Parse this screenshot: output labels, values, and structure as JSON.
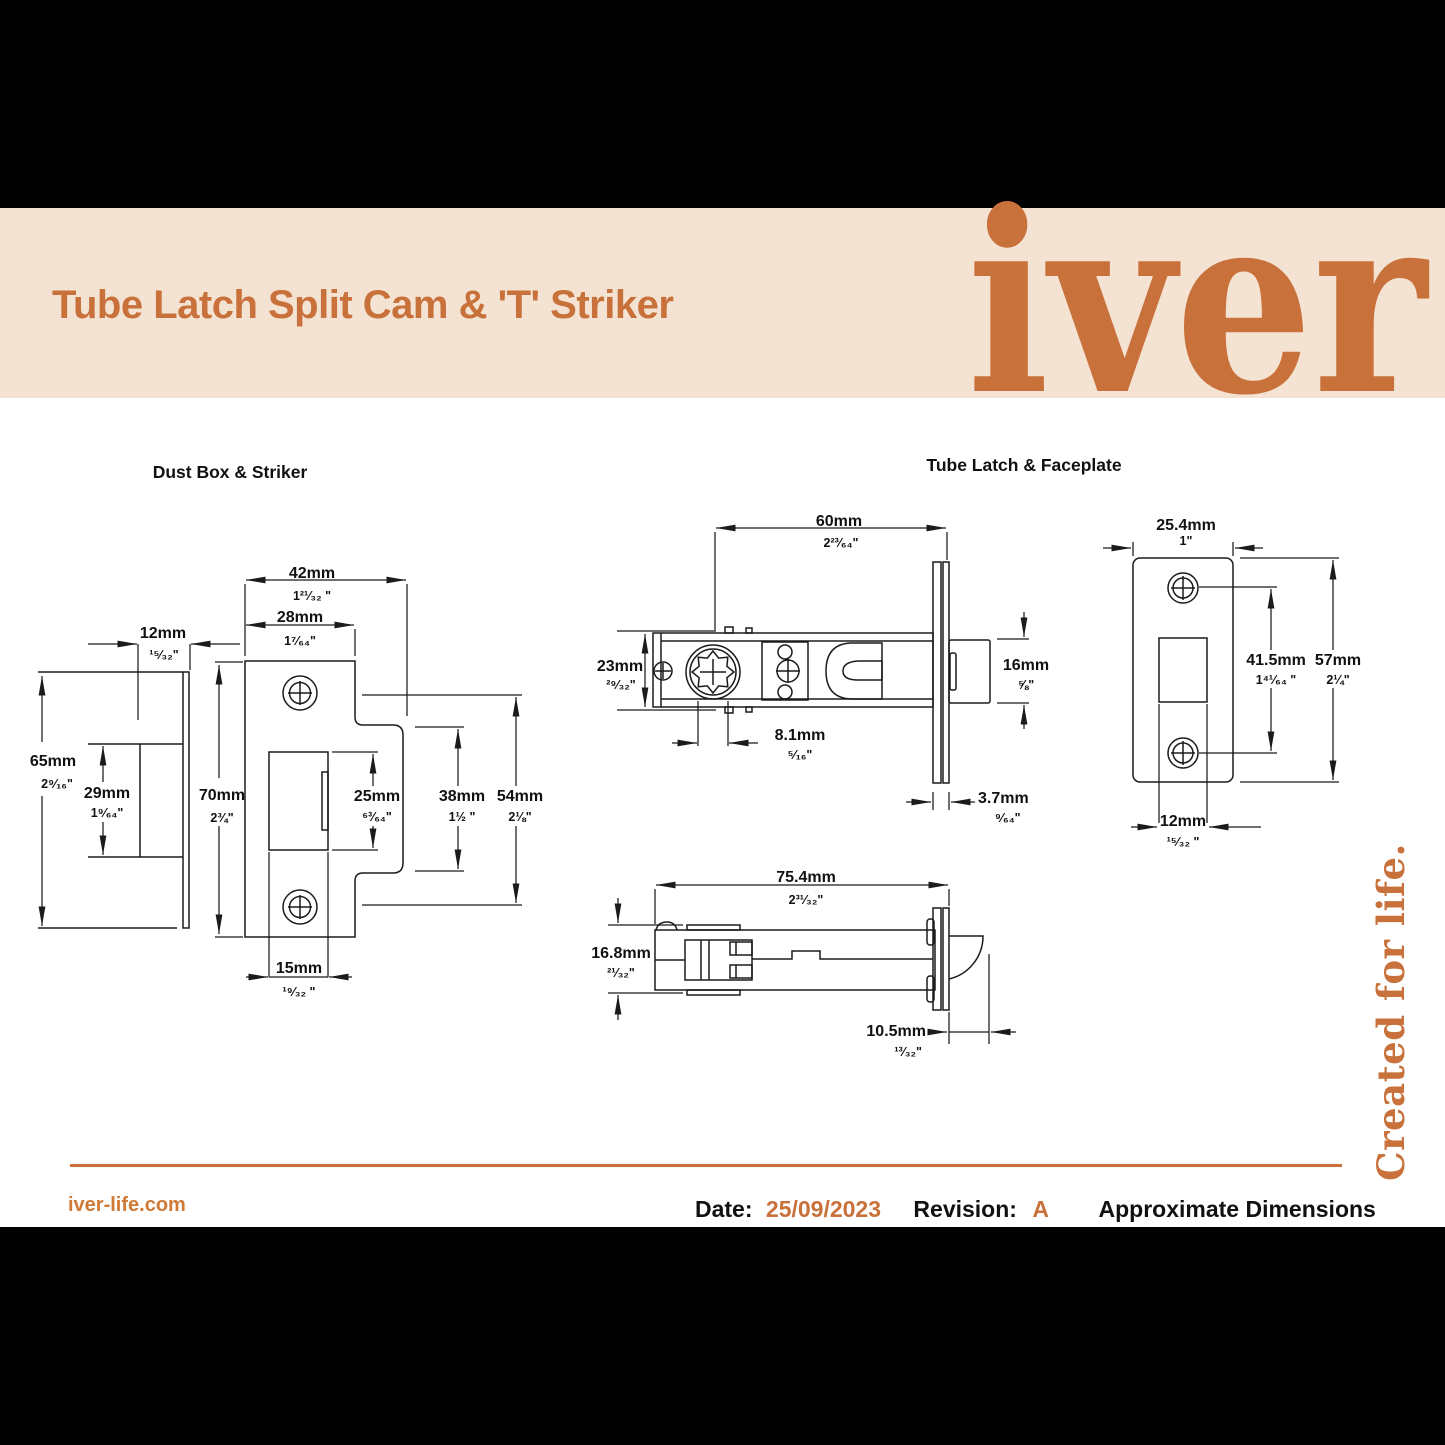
{
  "header": {
    "title": "Tube Latch Split Cam & 'T' Striker",
    "logo": "iver"
  },
  "tagline": "Created for life.",
  "footer": {
    "website": "iver-life.com",
    "date_label": "Date:",
    "date": "25/09/2023",
    "revision_label": "Revision:",
    "revision": "A",
    "note": "Approximate Dimensions"
  },
  "colors": {
    "accent": "#C8713B",
    "band": "#F4E3D2",
    "line": "#1B1B1B",
    "bar": "#000000"
  },
  "diagrams": {
    "dust_box_striker": {
      "title": "Dust Box & Striker",
      "dims": {
        "w42": {
          "mm": "42mm",
          "in": "1²¹⁄₃₂ \""
        },
        "w28": {
          "mm": "28mm",
          "in": "1⁷⁄₆₄\""
        },
        "w12": {
          "mm": "12mm",
          "in": "¹⁵⁄₃₂\""
        },
        "h65": {
          "mm": "65mm",
          "in": "2⁹⁄₁₆\""
        },
        "h29": {
          "mm": "29mm",
          "in": "1⁹⁄₆₄\""
        },
        "h70": {
          "mm": "70mm",
          "in": "2¾\""
        },
        "h25": {
          "mm": "25mm",
          "in": "⁶³⁄₆₄\""
        },
        "h38": {
          "mm": "38mm",
          "in": "1½ \""
        },
        "h54": {
          "mm": "54mm",
          "in": "2⅛\""
        },
        "w15": {
          "mm": "15mm",
          "in": "¹⁹⁄₃₂ \""
        }
      }
    },
    "tube_latch_faceplate": {
      "title": "Tube Latch & Faceplate",
      "dims": {
        "backset60": {
          "mm": "60mm",
          "in": "2²³⁄₆₄\""
        },
        "h23": {
          "mm": "23mm",
          "in": "²⁹⁄₃₂\""
        },
        "spindle81": {
          "mm": "8.1mm",
          "in": "⁵⁄₁₆\""
        },
        "bolt16": {
          "mm": "16mm",
          "in": "⅝\""
        },
        "t37": {
          "mm": "3.7mm",
          "in": "⁹⁄₆₄\""
        },
        "len754": {
          "mm": "75.4mm",
          "in": "2³¹⁄₃₂\""
        },
        "h168": {
          "mm": "16.8mm",
          "in": "²¹⁄₃₂\""
        },
        "p105": {
          "mm": "10.5mm",
          "in": "¹³⁄₃₂\""
        },
        "fw254": {
          "mm": "25.4mm",
          "in": "1\""
        },
        "c415": {
          "mm": "41.5mm",
          "in": "1⁴¹⁄₆₄ \""
        },
        "fh57": {
          "mm": "57mm",
          "in": "2¼\""
        },
        "cw12": {
          "mm": "12mm",
          "in": "¹⁵⁄₃₂ \""
        }
      }
    }
  }
}
